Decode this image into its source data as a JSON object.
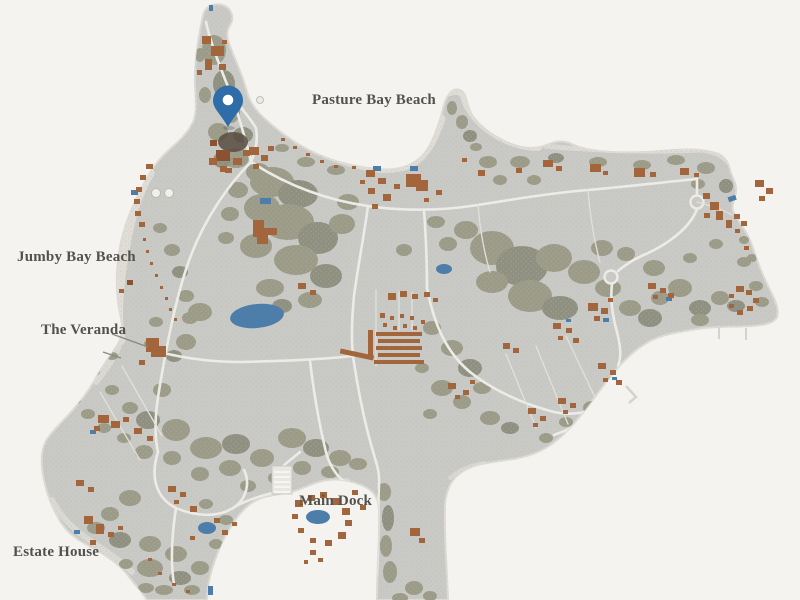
{
  "map": {
    "labels": {
      "pasture_bay_beach": "Pasture Bay Beach",
      "jumby_bay_beach": "Jumby Bay Beach",
      "the_veranda": "The Veranda",
      "main_dock": "Main Dock",
      "estate_house": "Estate House"
    },
    "marker": {
      "name": "location-pin",
      "color": "#2f6da8"
    },
    "colors": {
      "water": "#f4f3f0",
      "land": "#c9c9c6",
      "beach": "#dfddd6",
      "coast_edge": "#dcdad3",
      "vegetation": "#9b9b88",
      "vegetation_dark": "#8f9080",
      "building": "#a2653c",
      "building_dark": "#8a5230",
      "road": "#ecebe6",
      "path_thin": "#e2e0db",
      "pond": "#4d7ea9",
      "dock": "#e9e7e2",
      "pin": "#2f6da8",
      "label_text": "#52524d"
    }
  }
}
